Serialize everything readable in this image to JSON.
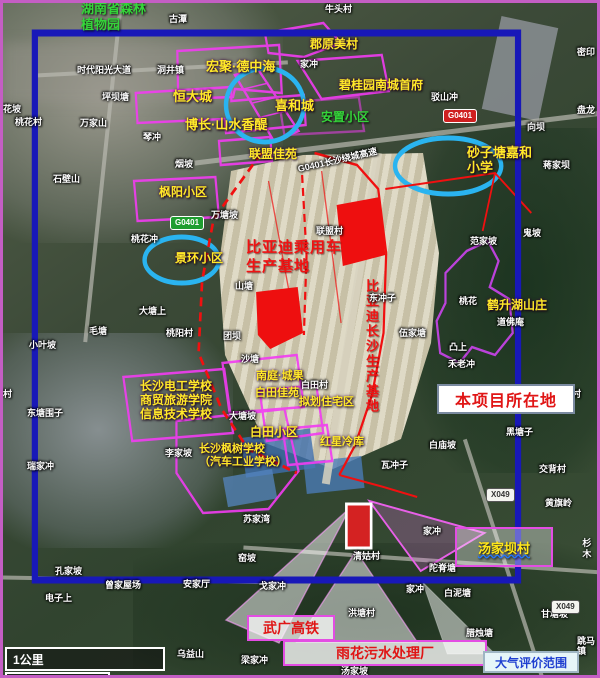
{
  "callouts": {
    "project_site": "本项目所在地",
    "air_eval_range": "大气评价范围",
    "rail": "武广高铁",
    "sewage_plant": "雨花污水处理厂",
    "village": "汤家坝村"
  },
  "scale_bar": {
    "km": "1公里",
    "ft": "3000英尺"
  },
  "colors": {
    "boundary_blue": "#1818b8",
    "annotation_magenta": "#f23cf2",
    "highlight_red": "#ee0f0f",
    "circle_blue": "#2ab4f0",
    "label_yellow": "#ffe929",
    "label_green": "#35d53a"
  },
  "road_signs": [
    {
      "label": "G0401",
      "c": "sign-red",
      "x": 440,
      "y": 106
    },
    {
      "label": "G0401",
      "c": "sign-green",
      "x": 167,
      "y": 213
    },
    {
      "label": "X049",
      "c": "sign-white",
      "x": 483,
      "y": 485
    },
    {
      "label": "X049",
      "c": "sign-white",
      "x": 548,
      "y": 597
    }
  ],
  "map_labels": [
    {
      "t": "湖南省森林\n植物园",
      "x": 78,
      "y": -2,
      "c": "g g13",
      "n": "label-botanical-garden"
    },
    {
      "t": "古潭",
      "x": 166,
      "y": 11,
      "c": "w"
    },
    {
      "t": "牛头村",
      "x": 322,
      "y": 1,
      "c": "w"
    },
    {
      "t": "郡原美村",
      "x": 307,
      "y": 35,
      "c": "y"
    },
    {
      "t": "家冲",
      "x": 297,
      "y": 56,
      "c": "w"
    },
    {
      "t": "宏聚·德中海",
      "x": 203,
      "y": 57,
      "c": "y y13"
    },
    {
      "t": "时代阳光大道",
      "x": 74,
      "y": 62,
      "c": "w"
    },
    {
      "t": "洞井镇",
      "x": 154,
      "y": 62,
      "c": "w"
    },
    {
      "t": "碧桂园南城首府",
      "x": 336,
      "y": 76,
      "c": "y"
    },
    {
      "t": "驳山冲",
      "x": 428,
      "y": 89,
      "c": "w"
    },
    {
      "t": "坪坝塘",
      "x": 99,
      "y": 89,
      "c": "w"
    },
    {
      "t": "密印",
      "x": 574,
      "y": 44,
      "c": "w"
    },
    {
      "t": "盘龙",
      "x": 574,
      "y": 102,
      "c": "w"
    },
    {
      "t": "恒大城",
      "x": 170,
      "y": 87,
      "c": "y y13"
    },
    {
      "t": "喜和城",
      "x": 272,
      "y": 96,
      "c": "y y13"
    },
    {
      "t": "花坡",
      "x": 0,
      "y": 101,
      "c": "w"
    },
    {
      "t": "安置小区",
      "x": 318,
      "y": 108,
      "c": "g"
    },
    {
      "t": "桃花村",
      "x": 12,
      "y": 114,
      "c": "w"
    },
    {
      "t": "万家山",
      "x": 77,
      "y": 115,
      "c": "w"
    },
    {
      "t": "博长·山水香醍",
      "x": 182,
      "y": 115,
      "c": "y y13"
    },
    {
      "t": "向坝",
      "x": 524,
      "y": 119,
      "c": "w"
    },
    {
      "t": "琴冲",
      "x": 140,
      "y": 129,
      "c": "w"
    },
    {
      "t": "G0401长沙绕城高速",
      "x": 294,
      "y": 152,
      "c": "w",
      "rot": -13
    },
    {
      "t": "联盟佳苑",
      "x": 246,
      "y": 145,
      "c": "y"
    },
    {
      "t": "蒋家坝",
      "x": 540,
      "y": 157,
      "c": "w"
    },
    {
      "t": "烟坡",
      "x": 172,
      "y": 156,
      "c": "w"
    },
    {
      "t": "砂子塘嘉和\n小学",
      "x": 464,
      "y": 143,
      "c": "y y13",
      "n": "label-school-shazitang"
    },
    {
      "t": "石壁山",
      "x": 50,
      "y": 171,
      "c": "w"
    },
    {
      "t": "枫阳小区",
      "x": 156,
      "y": 183,
      "c": "y"
    },
    {
      "t": "万塘坡",
      "x": 208,
      "y": 207,
      "c": "w"
    },
    {
      "t": "联盟村",
      "x": 313,
      "y": 223,
      "c": "w"
    },
    {
      "t": "鬼坡",
      "x": 520,
      "y": 225,
      "c": "w"
    },
    {
      "t": "桃花冲",
      "x": 128,
      "y": 231,
      "c": "w"
    },
    {
      "t": "范家坡",
      "x": 467,
      "y": 233,
      "c": "w"
    },
    {
      "t": "比亚迪乘用车\n生产基地",
      "x": 243,
      "y": 236,
      "c": "r",
      "n": "label-byd-base"
    },
    {
      "t": "景环小区",
      "x": 172,
      "y": 249,
      "c": "y"
    },
    {
      "t": "山塘",
      "x": 232,
      "y": 278,
      "c": "w"
    },
    {
      "t": "比亚迪长沙生产基地",
      "x": 360,
      "y": 276,
      "c": "rv v",
      "n": "label-byd-changsha-base"
    },
    {
      "t": "东冲子",
      "x": 366,
      "y": 290,
      "c": "w"
    },
    {
      "t": "桃花",
      "x": 456,
      "y": 293,
      "c": "w"
    },
    {
      "t": "鹤升湖山庄",
      "x": 484,
      "y": 296,
      "c": "y"
    },
    {
      "t": "大塘上",
      "x": 136,
      "y": 303,
      "c": "w"
    },
    {
      "t": "道佛庵",
      "x": 494,
      "y": 314,
      "c": "w"
    },
    {
      "t": "毛塘",
      "x": 86,
      "y": 323,
      "c": "w"
    },
    {
      "t": "伍家塘",
      "x": 396,
      "y": 325,
      "c": "w"
    },
    {
      "t": "桃阳村",
      "x": 163,
      "y": 325,
      "c": "w"
    },
    {
      "t": "团坝",
      "x": 220,
      "y": 328,
      "c": "w"
    },
    {
      "t": "小叶坡",
      "x": 26,
      "y": 337,
      "c": "w"
    },
    {
      "t": "凸上",
      "x": 446,
      "y": 339,
      "c": "w"
    },
    {
      "t": "沙塘",
      "x": 238,
      "y": 351,
      "c": "w"
    },
    {
      "t": "禾老冲",
      "x": 445,
      "y": 356,
      "c": "w"
    },
    {
      "t": "长沙电工学校\n商贸旅游学院\n信息技术学校",
      "x": 137,
      "y": 377,
      "c": "y",
      "n": "label-schools"
    },
    {
      "t": "南庭·城果",
      "x": 253,
      "y": 367,
      "c": "y y11"
    },
    {
      "t": "白田村",
      "x": 298,
      "y": 377,
      "c": "w"
    },
    {
      "t": "白田佳苑",
      "x": 252,
      "y": 384,
      "c": "y y11"
    },
    {
      "t": "升村",
      "x": 560,
      "y": 386,
      "c": "w"
    },
    {
      "t": "村",
      "x": 0,
      "y": 386,
      "c": "w"
    },
    {
      "t": "拟划住宅区",
      "x": 296,
      "y": 393,
      "c": "y y11"
    },
    {
      "t": "东塘围子",
      "x": 24,
      "y": 405,
      "c": "w"
    },
    {
      "t": "大塘坡",
      "x": 226,
      "y": 408,
      "c": "w"
    },
    {
      "t": "黑塘子",
      "x": 503,
      "y": 424,
      "c": "w"
    },
    {
      "t": "白田小区",
      "x": 247,
      "y": 423,
      "c": "y"
    },
    {
      "t": "红星冷库",
      "x": 317,
      "y": 433,
      "c": "y y11"
    },
    {
      "t": "白庙坡",
      "x": 426,
      "y": 437,
      "c": "w"
    },
    {
      "t": "长沙枫树学校\n（汽车工业学校）",
      "x": 196,
      "y": 440,
      "c": "y y11",
      "n": "label-auto-school"
    },
    {
      "t": "李家坡",
      "x": 162,
      "y": 445,
      "c": "w"
    },
    {
      "t": "瑞家冲",
      "x": 24,
      "y": 458,
      "c": "w"
    },
    {
      "t": "瓦冲子",
      "x": 378,
      "y": 457,
      "c": "w"
    },
    {
      "t": "交背村",
      "x": 536,
      "y": 461,
      "c": "w"
    },
    {
      "t": "黄旗岭",
      "x": 542,
      "y": 495,
      "c": "w"
    },
    {
      "t": "苏家湾",
      "x": 240,
      "y": 511,
      "c": "w"
    },
    {
      "t": "家冲",
      "x": 420,
      "y": 523,
      "c": "w"
    },
    {
      "t": "杉木",
      "x": 578,
      "y": 535,
      "c": "wv v"
    },
    {
      "t": "窑坡",
      "x": 235,
      "y": 550,
      "c": "w"
    },
    {
      "t": "清姑村",
      "x": 350,
      "y": 548,
      "c": "w"
    },
    {
      "t": "陀脊塘",
      "x": 426,
      "y": 560,
      "c": "w"
    },
    {
      "t": "孔家坡",
      "x": 52,
      "y": 563,
      "c": "w"
    },
    {
      "t": "安家厅",
      "x": 180,
      "y": 576,
      "c": "w"
    },
    {
      "t": "曾家屋场",
      "x": 102,
      "y": 577,
      "c": "w"
    },
    {
      "t": "戈家冲",
      "x": 256,
      "y": 578,
      "c": "w"
    },
    {
      "t": "家冲",
      "x": 403,
      "y": 581,
      "c": "w"
    },
    {
      "t": "白泥塘",
      "x": 441,
      "y": 585,
      "c": "w"
    },
    {
      "t": "电子上",
      "x": 42,
      "y": 590,
      "c": "w"
    },
    {
      "t": "甘塘坡",
      "x": 538,
      "y": 606,
      "c": "w"
    },
    {
      "t": "洪塘村",
      "x": 345,
      "y": 605,
      "c": "w"
    },
    {
      "t": "腊烛塘",
      "x": 463,
      "y": 625,
      "c": "w"
    },
    {
      "t": "跳马镇",
      "x": 574,
      "y": 633,
      "c": "w"
    },
    {
      "t": "乌益山",
      "x": 174,
      "y": 646,
      "c": "w"
    },
    {
      "t": "梁家冲",
      "x": 238,
      "y": 652,
      "c": "w"
    },
    {
      "t": "汤家坡",
      "x": 338,
      "y": 663,
      "c": "w"
    }
  ]
}
